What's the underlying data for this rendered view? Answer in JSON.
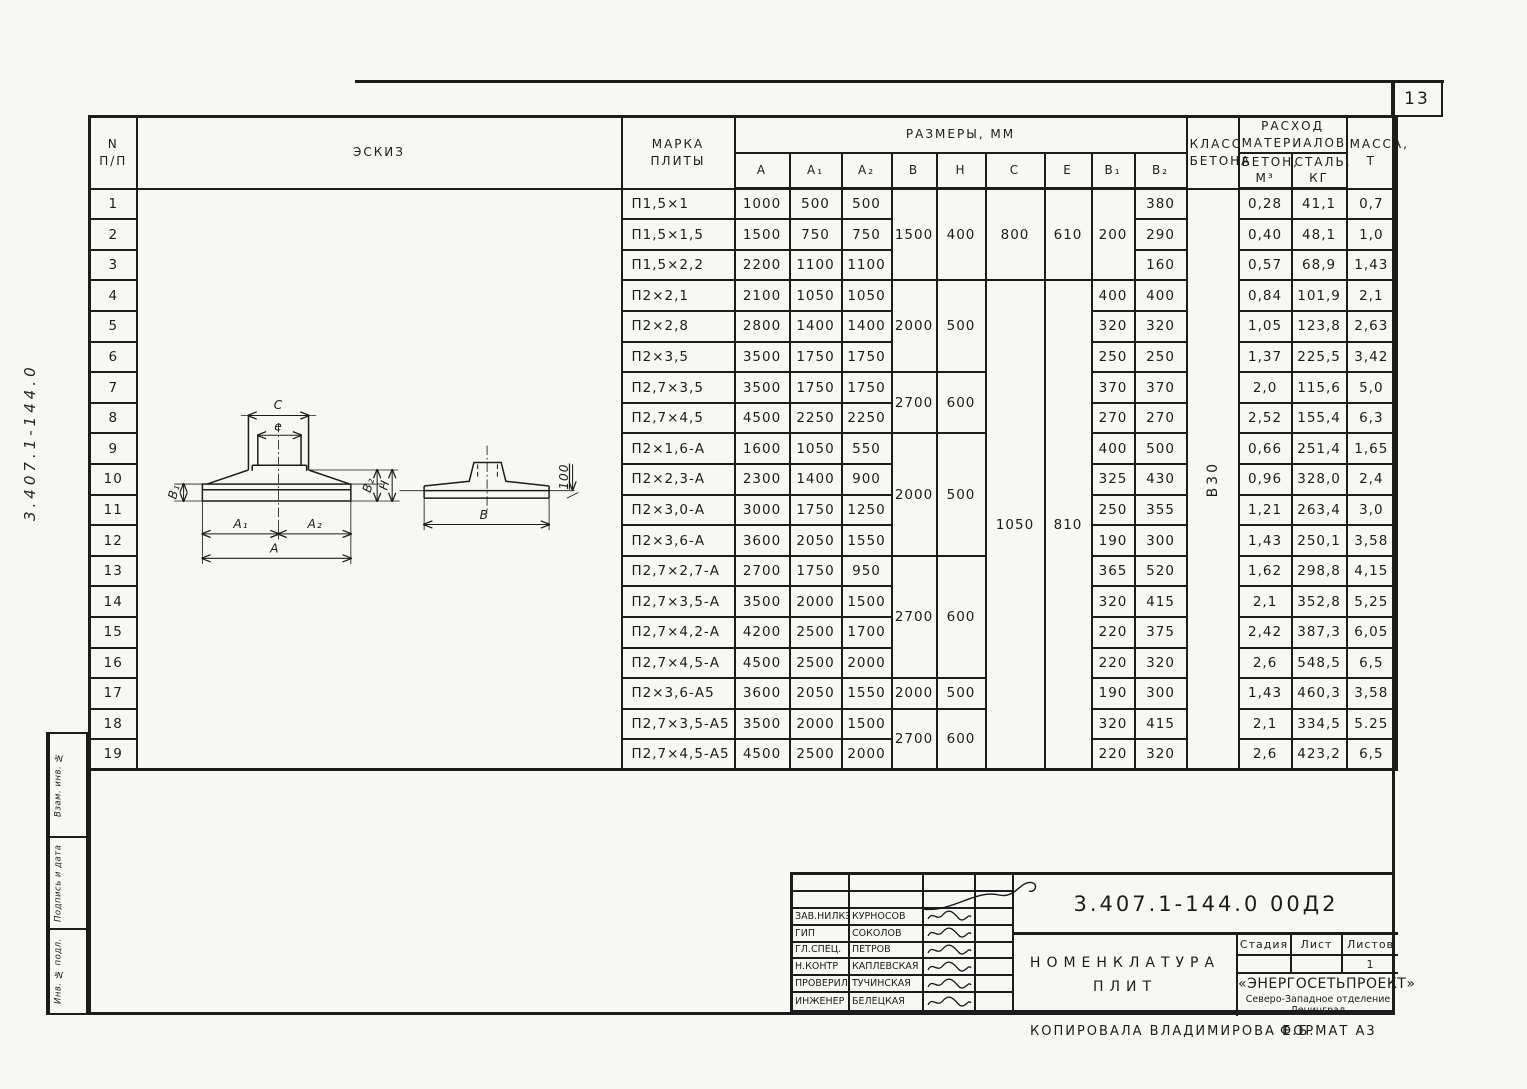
{
  "page": {
    "number": "13",
    "side_code": "3.407.1-144.0",
    "footer": {
      "copied_by": "Копировала Владимирова Е.Б.",
      "format": "Формат А3"
    }
  },
  "sidebar": {
    "labels": [
      "Взам. инв. №",
      "Подпись и дата",
      "Инв. № подл."
    ]
  },
  "table": {
    "headers": {
      "num": "N\nп/п",
      "sketch": "Эскиз",
      "mark": "Марка\nплиты",
      "dims_group": "Размеры, мм",
      "dims": [
        "A",
        "A₁",
        "A₂",
        "B",
        "H",
        "C",
        "e",
        "B₁",
        "B₂"
      ],
      "concrete_class": "Класс\nбетона",
      "materials_group": "Расход\nматериалов",
      "materials": [
        "Бетон,\nм³",
        "Сталь,\nкг"
      ],
      "mass": "Масса,\nт"
    },
    "concrete_class_value": "В30",
    "rows": [
      {
        "n": "1",
        "mark": "П1,5×1",
        "a": "1000",
        "a1": "500",
        "a2": "500",
        "b2": "380",
        "beton": "0,28",
        "stal": "41,1",
        "mass": "0,7"
      },
      {
        "n": "2",
        "mark": "П1,5×1,5",
        "a": "1500",
        "a1": "750",
        "a2": "750",
        "b2": "290",
        "beton": "0,40",
        "stal": "48,1",
        "mass": "1,0"
      },
      {
        "n": "3",
        "mark": "П1,5×2,2",
        "a": "2200",
        "a1": "1100",
        "a2": "1100",
        "b2": "160",
        "beton": "0,57",
        "stal": "68,9",
        "mass": "1,43"
      },
      {
        "n": "4",
        "mark": "П2×2,1",
        "a": "2100",
        "a1": "1050",
        "a2": "1050",
        "b1": "400",
        "b2": "400",
        "beton": "0,84",
        "stal": "101,9",
        "mass": "2,1"
      },
      {
        "n": "5",
        "mark": "П2×2,8",
        "a": "2800",
        "a1": "1400",
        "a2": "1400",
        "b1": "320",
        "b2": "320",
        "beton": "1,05",
        "stal": "123,8",
        "mass": "2,63"
      },
      {
        "n": "6",
        "mark": "П2×3,5",
        "a": "3500",
        "a1": "1750",
        "a2": "1750",
        "b1": "250",
        "b2": "250",
        "beton": "1,37",
        "stal": "225,5",
        "mass": "3,42"
      },
      {
        "n": "7",
        "mark": "П2,7×3,5",
        "a": "3500",
        "a1": "1750",
        "a2": "1750",
        "b1": "370",
        "b2": "370",
        "beton": "2,0",
        "stal": "115,6",
        "mass": "5,0"
      },
      {
        "n": "8",
        "mark": "П2,7×4,5",
        "a": "4500",
        "a1": "2250",
        "a2": "2250",
        "b1": "270",
        "b2": "270",
        "beton": "2,52",
        "stal": "155,4",
        "mass": "6,3"
      },
      {
        "n": "9",
        "mark": "П2×1,6-А",
        "a": "1600",
        "a1": "1050",
        "a2": "550",
        "b1": "400",
        "b2": "500",
        "beton": "0,66",
        "stal": "251,4",
        "mass": "1,65"
      },
      {
        "n": "10",
        "mark": "П2×2,3-А",
        "a": "2300",
        "a1": "1400",
        "a2": "900",
        "b1": "325",
        "b2": "430",
        "beton": "0,96",
        "stal": "328,0",
        "mass": "2,4"
      },
      {
        "n": "11",
        "mark": "П2×3,0-А",
        "a": "3000",
        "a1": "1750",
        "a2": "1250",
        "b1": "250",
        "b2": "355",
        "beton": "1,21",
        "stal": "263,4",
        "mass": "3,0"
      },
      {
        "n": "12",
        "mark": "П2×3,6-А",
        "a": "3600",
        "a1": "2050",
        "a2": "1550",
        "b1": "190",
        "b2": "300",
        "beton": "1,43",
        "stal": "250,1",
        "mass": "3,58"
      },
      {
        "n": "13",
        "mark": "П2,7×2,7-А",
        "a": "2700",
        "a1": "1750",
        "a2": "950",
        "b1": "365",
        "b2": "520",
        "beton": "1,62",
        "stal": "298,8",
        "mass": "4,15"
      },
      {
        "n": "14",
        "mark": "П2,7×3,5-А",
        "a": "3500",
        "a1": "2000",
        "a2": "1500",
        "b1": "320",
        "b2": "415",
        "beton": "2,1",
        "stal": "352,8",
        "mass": "5,25"
      },
      {
        "n": "15",
        "mark": "П2,7×4,2-А",
        "a": "4200",
        "a1": "2500",
        "a2": "1700",
        "b1": "220",
        "b2": "375",
        "beton": "2,42",
        "stal": "387,3",
        "mass": "6,05"
      },
      {
        "n": "16",
        "mark": "П2,7×4,5-А",
        "a": "4500",
        "a1": "2500",
        "a2": "2000",
        "b1": "220",
        "b2": "320",
        "beton": "2,6",
        "stal": "548,5",
        "mass": "6,5"
      },
      {
        "n": "17",
        "mark": "П2×3,6-А5",
        "a": "3600",
        "a1": "2050",
        "a2": "1550",
        "b1": "190",
        "b2": "300",
        "beton": "1,43",
        "stal": "460,3",
        "mass": "3,58"
      },
      {
        "n": "18",
        "mark": "П2,7×3,5-А5",
        "a": "3500",
        "a1": "2000",
        "a2": "1500",
        "b1": "320",
        "b2": "415",
        "beton": "2,1",
        "stal": "334,5",
        "mass": "5.25"
      },
      {
        "n": "19",
        "mark": "П2,7×4,5-А5",
        "a": "4500",
        "a1": "2500",
        "a2": "2000",
        "b1": "220",
        "b2": "320",
        "beton": "2,6",
        "stal": "423,2",
        "mass": "6,5"
      }
    ],
    "bh_spans": [
      {
        "from": 1,
        "to": 3,
        "b": "1500",
        "h": "400"
      },
      {
        "from": 4,
        "to": 6,
        "b": "2000",
        "h": "500"
      },
      {
        "from": 7,
        "to": 8,
        "b": "2700",
        "h": "600"
      },
      {
        "from": 9,
        "to": 12,
        "b": "2000",
        "h": "500"
      },
      {
        "from": 13,
        "to": 16,
        "b": "2700",
        "h": "600"
      },
      {
        "from": 17,
        "to": 17,
        "b": "2000",
        "h": "500"
      },
      {
        "from": 18,
        "to": 19,
        "b": "2700",
        "h": "600"
      }
    ],
    "ce_spans": [
      {
        "from": 1,
        "to": 3,
        "c": "800",
        "e": "610"
      },
      {
        "from": 4,
        "to": 19,
        "c": "1050",
        "e": "810"
      }
    ],
    "b1_spans": [
      {
        "from": 1,
        "to": 3,
        "v": "200"
      }
    ]
  },
  "sketch": {
    "labels": {
      "c": "C",
      "e": "e",
      "b1": "B₁",
      "b2": "B₂",
      "h": "H",
      "a1": "A₁",
      "a2": "A₂",
      "a": "A",
      "b": "B",
      "dim100": "100"
    }
  },
  "stamp": {
    "doc_number": "3.407.1-144.0   00Д2",
    "title_line1": "Номенклатура",
    "title_line2": "плит",
    "signatures": [
      {
        "role": "Зав.НИЛКЭ",
        "name": "Курносов"
      },
      {
        "role": "ГИП",
        "name": "Соколов"
      },
      {
        "role": "Гл.спец.",
        "name": "Петров"
      },
      {
        "role": "Н.контр",
        "name": "Каплевская"
      },
      {
        "role": "Проверила",
        "name": "Тучинская"
      },
      {
        "role": "Инженер",
        "name": "Белецкая"
      }
    ],
    "stage_headers": [
      "Стадия",
      "Лист",
      "Листов"
    ],
    "sheets_value": "1",
    "org_name": "«ЭНЕРГОСЕТЬПРОЕКТ»",
    "org_branch": "Северо-Западное отделение",
    "org_city": "Ленинград"
  }
}
